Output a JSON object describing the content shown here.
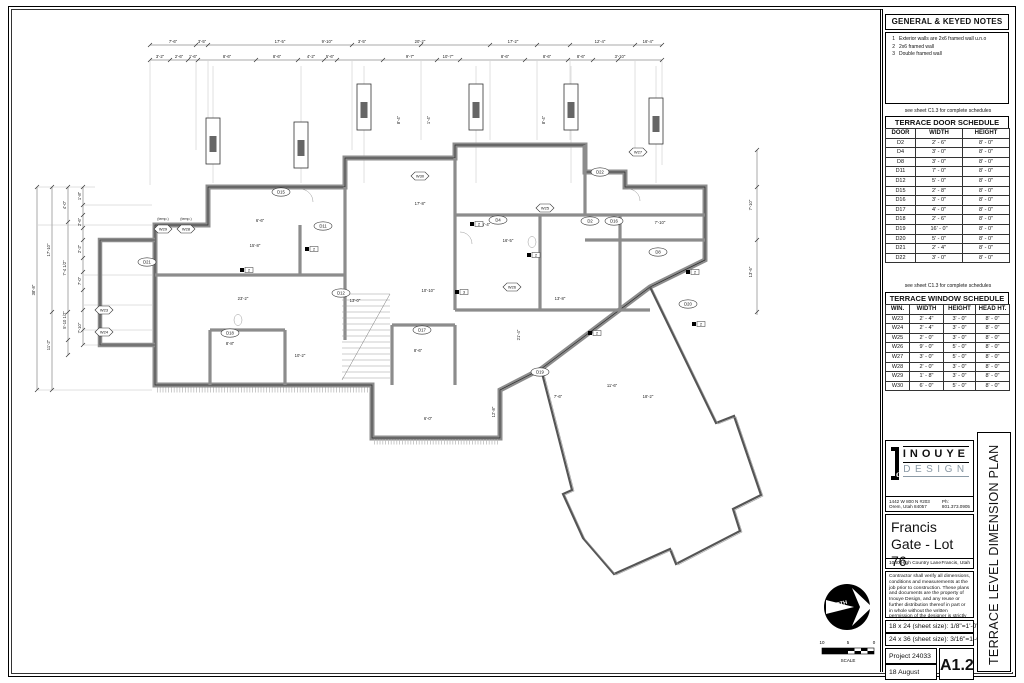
{
  "title_block": {
    "notes": {
      "title": "GENERAL & KEYED NOTES",
      "items": [
        {
          "num": "1",
          "text": "Exterior walls are 2x6 framed wall u.n.o"
        },
        {
          "num": "2",
          "text": "2x6 framed wall"
        },
        {
          "num": "3",
          "text": "Double framed wall"
        }
      ]
    },
    "schedule_note": "see sheet C1.3 for complete schedules",
    "door_schedule": {
      "title": "TERRACE DOOR SCHEDULE",
      "headers": [
        "DOOR",
        "WIDTH",
        "HEIGHT"
      ],
      "rows": [
        [
          "D2",
          "2' - 6\"",
          "8' - 0\""
        ],
        [
          "D4",
          "3' - 0\"",
          "8' - 0\""
        ],
        [
          "D8",
          "3' - 0\"",
          "8' - 0\""
        ],
        [
          "D11",
          "7' - 0\"",
          "8' - 0\""
        ],
        [
          "D12",
          "5' - 0\"",
          "8' - 0\""
        ],
        [
          "D15",
          "2' - 8\"",
          "8' - 0\""
        ],
        [
          "D16",
          "3' - 0\"",
          "8' - 0\""
        ],
        [
          "D17",
          "4' - 0\"",
          "8' - 0\""
        ],
        [
          "D18",
          "2' - 6\"",
          "8' - 0\""
        ],
        [
          "D19",
          "16' - 0\"",
          "8' - 0\""
        ],
        [
          "D20",
          "5' - 0\"",
          "8' - 0\""
        ],
        [
          "D21",
          "2' - 4\"",
          "8' - 0\""
        ],
        [
          "D22",
          "3' - 0\"",
          "8' - 0\""
        ]
      ]
    },
    "window_schedule": {
      "title": "TERRACE WINDOW SCHEDULE",
      "headers": [
        "WIN.",
        "WIDTH",
        "HEIGHT",
        "HEAD HT."
      ],
      "rows": [
        [
          "W23",
          "2' - 4\"",
          "3' - 0\"",
          "8' - 0\""
        ],
        [
          "W24",
          "2' - 4\"",
          "3' - 0\"",
          "8' - 0\""
        ],
        [
          "W25",
          "2' - 0\"",
          "3' - 0\"",
          "8' - 0\""
        ],
        [
          "W26",
          "9' - 0\"",
          "5' - 0\"",
          "8' - 0\""
        ],
        [
          "W27",
          "3' - 0\"",
          "5' - 0\"",
          "8' - 0\""
        ],
        [
          "W28",
          "2' - 0\"",
          "3' - 0\"",
          "8' - 0\""
        ],
        [
          "W29",
          "1' - 8\"",
          "3' - 0\"",
          "8' - 0\""
        ],
        [
          "W30",
          "6' - 0\"",
          "5' - 0\"",
          "8' - 0\""
        ]
      ]
    },
    "firm": {
      "name_top": "INOUYE",
      "name_bottom": "DESIGN",
      "accent": "#8b9aa6",
      "address": "1442 W 800 N #203 Orem, Utah 84057",
      "phone": "Ph: 801.373.0905"
    },
    "project": {
      "name": "Francis Gate - Lot 76",
      "street": "1040 High Country Lane",
      "city": "Francis, Utah"
    },
    "disclaimer": "Contractor shall verify all dimensions, conditions and measurements at the job prior to construction. These plans and documents are the property of Inouye Design, and any reuse or further distribution thereof in part or in whole without the written permission of the designer is strictly prohibited. Designer is not an architect or engineer.",
    "copyright": "© Copyright 2025 Inouye Design",
    "sheet_sizes": [
      "18 x 24 (sheet size): 1/8\"=1'-0\"",
      "24 x 36 (sheet size): 3/16\"=1'-0\""
    ],
    "project_number": "Project 24033",
    "date": "18 August 2025",
    "sheet_number": "A1.2",
    "sheet_title": "TERRACE LEVEL DIMENSION PLAN"
  },
  "north_arrow": {
    "label": "NORTH"
  },
  "scale_bar": {
    "label": "SCALE",
    "ticks": [
      "10",
      "5",
      "0"
    ]
  },
  "plan": {
    "colors": {
      "wall": "#8c8c8c",
      "wall_edge": "#2a2a2a",
      "dim": "#555555",
      "ext": "#b0b0b0"
    },
    "columns": [
      {
        "x": 213,
        "y": 118
      },
      {
        "x": 301,
        "y": 122
      },
      {
        "x": 364,
        "y": 84
      },
      {
        "x": 476,
        "y": 84
      },
      {
        "x": 571,
        "y": 84
      },
      {
        "x": 656,
        "y": 98
      }
    ],
    "ticks_h": [
      {
        "y": 45,
        "xs": [
          150,
          196,
          208,
          352,
          421,
          490,
          537,
          570,
          635,
          662
        ]
      },
      {
        "y": 60,
        "xs": [
          150,
          170,
          188,
          198,
          256,
          298,
          324,
          337,
          383,
          437,
          460,
          525,
          568,
          593,
          618,
          662
        ]
      }
    ],
    "ticks_v": [
      {
        "x": 37,
        "ys": [
          187,
          390
        ]
      },
      {
        "x": 52,
        "ys": [
          187,
          312,
          390
        ]
      },
      {
        "x": 68,
        "ys": [
          187,
          222,
          312,
          340,
          355
        ]
      },
      {
        "x": 83,
        "ys": [
          187,
          205,
          215,
          228,
          240,
          258,
          272,
          290,
          310,
          330,
          345
        ]
      },
      {
        "x": 757,
        "ys": [
          150,
          187,
          240,
          312
        ]
      }
    ],
    "ext_v": [
      {
        "x": 150,
        "y1": 61,
        "y2": 185
      },
      {
        "x": 196,
        "y1": 61,
        "y2": 150
      },
      {
        "x": 208,
        "y1": 61,
        "y2": 150
      },
      {
        "x": 352,
        "y1": 61,
        "y2": 150
      },
      {
        "x": 421,
        "y1": 61,
        "y2": 140
      },
      {
        "x": 490,
        "y1": 61,
        "y2": 140
      },
      {
        "x": 537,
        "y1": 61,
        "y2": 140
      },
      {
        "x": 570,
        "y1": 61,
        "y2": 140
      },
      {
        "x": 635,
        "y1": 61,
        "y2": 150
      },
      {
        "x": 662,
        "y1": 61,
        "y2": 165
      },
      {
        "x": 213,
        "y1": 66,
        "y2": 183
      },
      {
        "x": 301,
        "y1": 66,
        "y2": 183
      },
      {
        "x": 364,
        "y1": 66,
        "y2": 183
      },
      {
        "x": 476,
        "y1": 66,
        "y2": 183
      },
      {
        "x": 571,
        "y1": 66,
        "y2": 183
      },
      {
        "x": 656,
        "y1": 66,
        "y2": 183
      }
    ],
    "ext_h": [
      {
        "y": 187,
        "x1": 38,
        "x2": 95
      },
      {
        "y": 205,
        "x1": 84,
        "x2": 152
      },
      {
        "y": 225,
        "x1": 38,
        "x2": 152
      },
      {
        "y": 275,
        "x1": 84,
        "x2": 152
      },
      {
        "y": 305,
        "x1": 84,
        "x2": 152
      },
      {
        "y": 330,
        "x1": 84,
        "x2": 152
      },
      {
        "y": 345,
        "x1": 84,
        "x2": 152
      },
      {
        "y": 390,
        "x1": 38,
        "x2": 152
      }
    ],
    "dim_labels": [
      {
        "x": 173,
        "y": 43,
        "t": "7'-6\""
      },
      {
        "x": 202,
        "y": 43,
        "t": "3'-5\""
      },
      {
        "x": 280,
        "y": 43,
        "t": "17'-5\""
      },
      {
        "x": 327,
        "y": 43,
        "t": "9'-10\""
      },
      {
        "x": 362,
        "y": 43,
        "t": "3'-5\""
      },
      {
        "x": 420,
        "y": 43,
        "t": "20'-2\""
      },
      {
        "x": 513,
        "y": 43,
        "t": "17'-2\""
      },
      {
        "x": 600,
        "y": 43,
        "t": "12'-4\""
      },
      {
        "x": 648,
        "y": 43,
        "t": "16'-4\""
      },
      {
        "x": 160,
        "y": 58,
        "t": "3'-2\""
      },
      {
        "x": 179,
        "y": 58,
        "t": "2'-6\""
      },
      {
        "x": 193,
        "y": 58,
        "t": "1'-6\""
      },
      {
        "x": 227,
        "y": 58,
        "t": "8'-6\""
      },
      {
        "x": 277,
        "y": 58,
        "t": "8'-6\""
      },
      {
        "x": 311,
        "y": 58,
        "t": "4'-2\""
      },
      {
        "x": 330,
        "y": 58,
        "t": "5'-6\""
      },
      {
        "x": 410,
        "y": 58,
        "t": "9'-7\""
      },
      {
        "x": 448,
        "y": 58,
        "t": "10'-7\""
      },
      {
        "x": 505,
        "y": 58,
        "t": "8'-6\""
      },
      {
        "x": 547,
        "y": 58,
        "t": "8'-6\""
      },
      {
        "x": 581,
        "y": 58,
        "t": "8'-6\""
      },
      {
        "x": 620,
        "y": 58,
        "t": "3'-10\""
      },
      {
        "x": 35,
        "y": 290,
        "t": "38'-8\"",
        "r": 1
      },
      {
        "x": 50,
        "y": 250,
        "t": "17'-10\"",
        "r": 1
      },
      {
        "x": 50,
        "y": 345,
        "t": "11'-2\"",
        "r": 1
      },
      {
        "x": 66,
        "y": 205,
        "t": "4'-0\"",
        "r": 1
      },
      {
        "x": 66,
        "y": 268,
        "t": "7'-4 1/2\"",
        "r": 1
      },
      {
        "x": 66,
        "y": 320,
        "t": "5'-10 1/2\"",
        "r": 1
      },
      {
        "x": 81,
        "y": 196,
        "t": "1'-8\"",
        "r": 1
      },
      {
        "x": 81,
        "y": 222,
        "t": "2'-6\"",
        "r": 1
      },
      {
        "x": 81,
        "y": 249,
        "t": "2'-2\"",
        "r": 1
      },
      {
        "x": 81,
        "y": 281,
        "t": "7'-0\"",
        "r": 1
      },
      {
        "x": 81,
        "y": 328,
        "t": "7'-10\"",
        "r": 1
      },
      {
        "x": 400,
        "y": 120,
        "t": "8'-4\"",
        "r": 1
      },
      {
        "x": 430,
        "y": 120,
        "t": "1'-4\"",
        "r": 1
      },
      {
        "x": 545,
        "y": 120,
        "t": "8'-4\"",
        "r": 1
      },
      {
        "x": 752,
        "y": 205,
        "t": "7'-10\"",
        "r": 1
      },
      {
        "x": 752,
        "y": 272,
        "t": "13'-6\"",
        "r": 1
      },
      {
        "x": 520,
        "y": 335,
        "t": "21'-4\"",
        "r": 1
      },
      {
        "x": 495,
        "y": 412,
        "t": "12'-8\"",
        "r": 1
      },
      {
        "x": 255,
        "y": 247,
        "t": "15'-8\""
      },
      {
        "x": 243,
        "y": 300,
        "t": "23'-2\""
      },
      {
        "x": 420,
        "y": 205,
        "t": "17'-8\""
      },
      {
        "x": 508,
        "y": 242,
        "t": "16'-5\""
      },
      {
        "x": 560,
        "y": 300,
        "t": "13'-8\""
      },
      {
        "x": 428,
        "y": 292,
        "t": "10'-10\""
      },
      {
        "x": 355,
        "y": 302,
        "t": "13'-0\""
      },
      {
        "x": 300,
        "y": 357,
        "t": "10'-2\""
      },
      {
        "x": 418,
        "y": 352,
        "t": "8'-6\""
      },
      {
        "x": 612,
        "y": 387,
        "t": "11'-6\""
      },
      {
        "x": 558,
        "y": 398,
        "t": "7'-6\""
      },
      {
        "x": 648,
        "y": 398,
        "t": "18'-2\""
      },
      {
        "x": 260,
        "y": 222,
        "t": "6'-6\""
      },
      {
        "x": 486,
        "y": 226,
        "t": "5'-4\""
      },
      {
        "x": 660,
        "y": 224,
        "t": "7'-10\""
      },
      {
        "x": 230,
        "y": 345,
        "t": "8'-8\""
      },
      {
        "x": 428,
        "y": 420,
        "t": "6'-0\""
      },
      {
        "x": 163,
        "y": 220,
        "t": "(temp.)",
        "s": 3.6
      },
      {
        "x": 186,
        "y": 220,
        "t": "(temp.)",
        "s": 3.6
      }
    ],
    "door_tags": [
      {
        "x": 281,
        "y": 192,
        "t": "D15"
      },
      {
        "x": 323,
        "y": 226,
        "t": "D11"
      },
      {
        "x": 341,
        "y": 293,
        "t": "D12"
      },
      {
        "x": 230,
        "y": 333,
        "t": "D18"
      },
      {
        "x": 422,
        "y": 330,
        "t": "D17"
      },
      {
        "x": 498,
        "y": 220,
        "t": "D4"
      },
      {
        "x": 590,
        "y": 221,
        "t": "D2"
      },
      {
        "x": 614,
        "y": 221,
        "t": "D16"
      },
      {
        "x": 658,
        "y": 252,
        "t": "D8"
      },
      {
        "x": 540,
        "y": 372,
        "t": "D19"
      },
      {
        "x": 147,
        "y": 262,
        "t": "D21"
      },
      {
        "x": 600,
        "y": 172,
        "t": "D22"
      },
      {
        "x": 688,
        "y": 304,
        "t": "D20"
      }
    ],
    "window_tags": [
      {
        "x": 163,
        "y": 229,
        "t": "W29"
      },
      {
        "x": 186,
        "y": 229,
        "t": "W28"
      },
      {
        "x": 104,
        "y": 310,
        "t": "W23"
      },
      {
        "x": 104,
        "y": 332,
        "t": "W24"
      },
      {
        "x": 420,
        "y": 176,
        "t": "W30"
      },
      {
        "x": 545,
        "y": 208,
        "t": "W25"
      },
      {
        "x": 512,
        "y": 287,
        "t": "W26"
      },
      {
        "x": 638,
        "y": 152,
        "t": "W27"
      }
    ],
    "keyed_markers": [
      {
        "x": 305,
        "y": 247,
        "n": "2"
      },
      {
        "x": 470,
        "y": 222,
        "n": "2"
      },
      {
        "x": 527,
        "y": 253,
        "n": "2"
      },
      {
        "x": 686,
        "y": 270,
        "n": "2"
      },
      {
        "x": 692,
        "y": 322,
        "n": "2"
      },
      {
        "x": 455,
        "y": 290,
        "n": "3"
      },
      {
        "x": 240,
        "y": 268,
        "n": "2"
      },
      {
        "x": 588,
        "y": 331,
        "n": "2"
      }
    ]
  }
}
